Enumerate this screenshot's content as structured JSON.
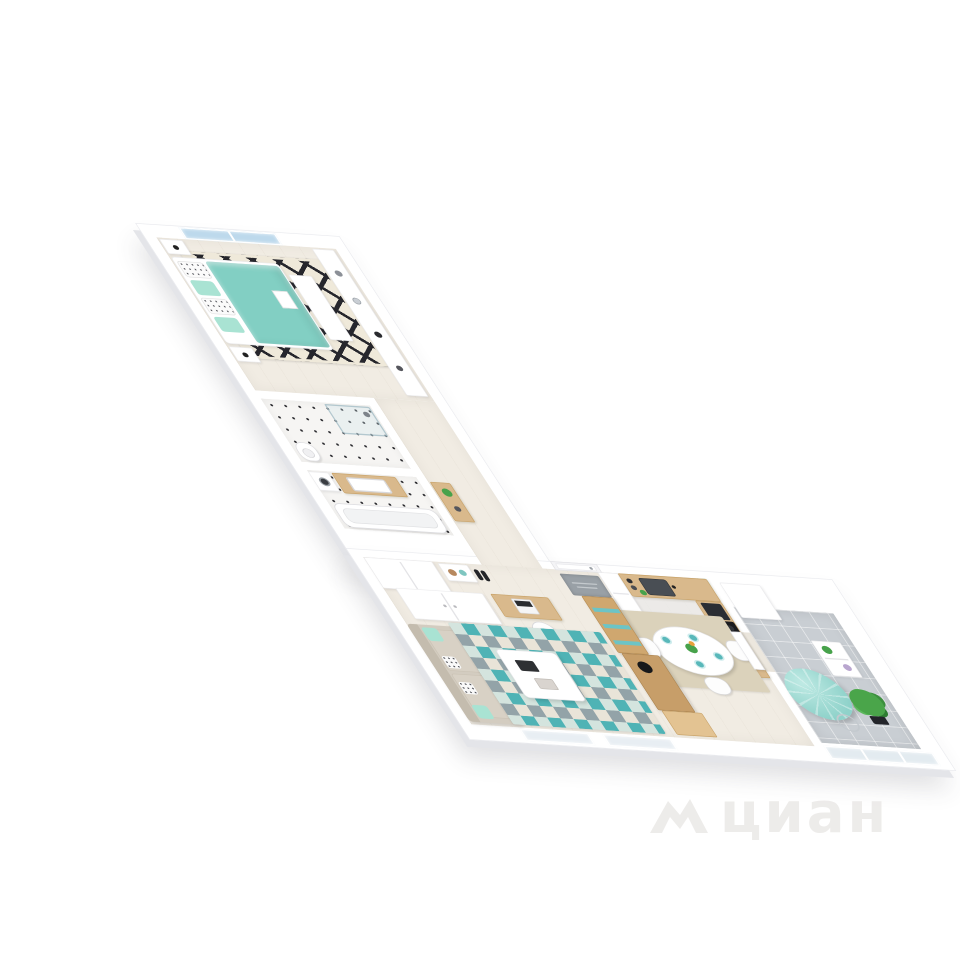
{
  "watermark": {
    "text": "циан",
    "logo": "cian-roof-icon"
  },
  "colors": {
    "wall": "#ffffff",
    "wall_edge": "#e9eaee",
    "wall_shade": "#e4e5e9",
    "floor": "#f1ece3",
    "floor_kitchen": "#e9eaea",
    "floor_balcony": "#c9ced3",
    "tile_dot": "#2c2c30",
    "teal_duvet": "#82cfc3",
    "teal_bright": "#4fb3b5",
    "mint": "#a9e3d3",
    "rug_cream": "#efe9da",
    "rug_black": "#26262c",
    "beige_rug": "#dbd2bb",
    "wood": "#d9b98c",
    "wood_dark": "#c79e69",
    "wood_light": "#e3c392",
    "sofa_greige": "#d3ccc0",
    "sofa_dark": "#c4bcae",
    "appliance_dark": "#1b1c1f",
    "steel": "#494e54",
    "glass": "#bdd9ec",
    "plant": "#47a24b",
    "mat_grey": "#99a0a6",
    "watermark": "#edebe9"
  },
  "scene": {
    "type": "3d-floorplan-render",
    "rooms": [
      {
        "name": "bedroom",
        "furniture": [
          "double-bed-teal-duvet",
          "dotted-pillows",
          "mint-pillows",
          "black-white-diamond-rug",
          "two-nightstands-with-lamps",
          "white-dresser-shelf",
          "foot-bench",
          "blue-window"
        ]
      },
      {
        "name": "bathroom-1",
        "furniture": [
          "glass-shower",
          "toilet",
          "dotted-tile-floor"
        ]
      },
      {
        "name": "bathroom-2",
        "furniture": [
          "wood-vanity-with-sink",
          "washing-machine",
          "bathtub",
          "dotted-tile-floor"
        ]
      },
      {
        "name": "corridor",
        "furniture": [
          "wood-console",
          "green-plant"
        ]
      },
      {
        "name": "hallway",
        "furniture": [
          "sliding-wardrobe",
          "shoe-bench",
          "black-shoes",
          "grey-doormat",
          "entrance-door"
        ]
      },
      {
        "name": "kitchen",
        "furniture": [
          "fridge",
          "l-shaped-wood-counter",
          "double-sink",
          "teal-glass-splashback",
          "coffee-machine",
          "induction-hob-with-oven",
          "jars"
        ]
      },
      {
        "name": "dining-area",
        "furniture": [
          "white-round-table",
          "four-teal-place-settings",
          "flower-vase",
          "three-white-chairs",
          "beige-rug",
          "tall-wood-shelf-teal-accents",
          "wood-sideboard-with-black-bowl",
          "wood-desk"
        ]
      },
      {
        "name": "living-room",
        "furniture": [
          "greige-sofa",
          "mint-pillows",
          "white-coffee-table",
          "two-books",
          "teal-geometric-rug",
          "desk-with-laptop",
          "white-chair",
          "white-wardrobe",
          "floor-lamp",
          "two-bottom-windows"
        ]
      },
      {
        "name": "balcony",
        "furniture": [
          "teal-bean-bag-pouf",
          "potted-plant",
          "white-etagere-with-plants",
          "watering-ring",
          "glass-railing",
          "grey-tile-floor",
          "white-cabinet"
        ]
      }
    ]
  }
}
